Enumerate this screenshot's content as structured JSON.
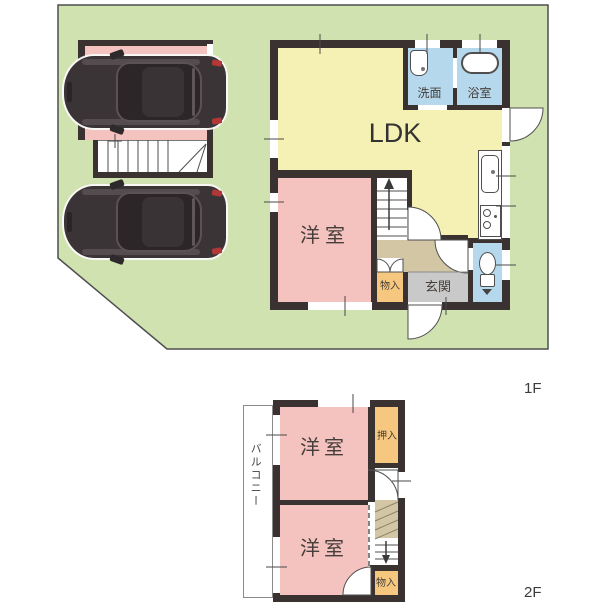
{
  "floor1": {
    "label": "1F",
    "rooms": {
      "ldk": "LDK",
      "bedroom": "洋室",
      "washroom": "洗面",
      "bathroom": "浴室",
      "entrance": "玄関",
      "storage": "物入"
    }
  },
  "floor2": {
    "label": "2F",
    "rooms": {
      "bedroom_a": "洋室",
      "bedroom_b": "洋室",
      "closet": "押入",
      "storage": "物入",
      "balcony": "バルコニー"
    }
  },
  "colors": {
    "lot_green": "#cfe2af",
    "room_pink": "#f4c3bf",
    "ldk_yellow": "#f5f0b4",
    "wet_area_blue": "#b5d8ec",
    "closet_orange": "#f6c87f",
    "entrance_gray": "#c9c9c9",
    "hall_beige": "#d3c6a4",
    "wall_dark": "#3a3230"
  }
}
